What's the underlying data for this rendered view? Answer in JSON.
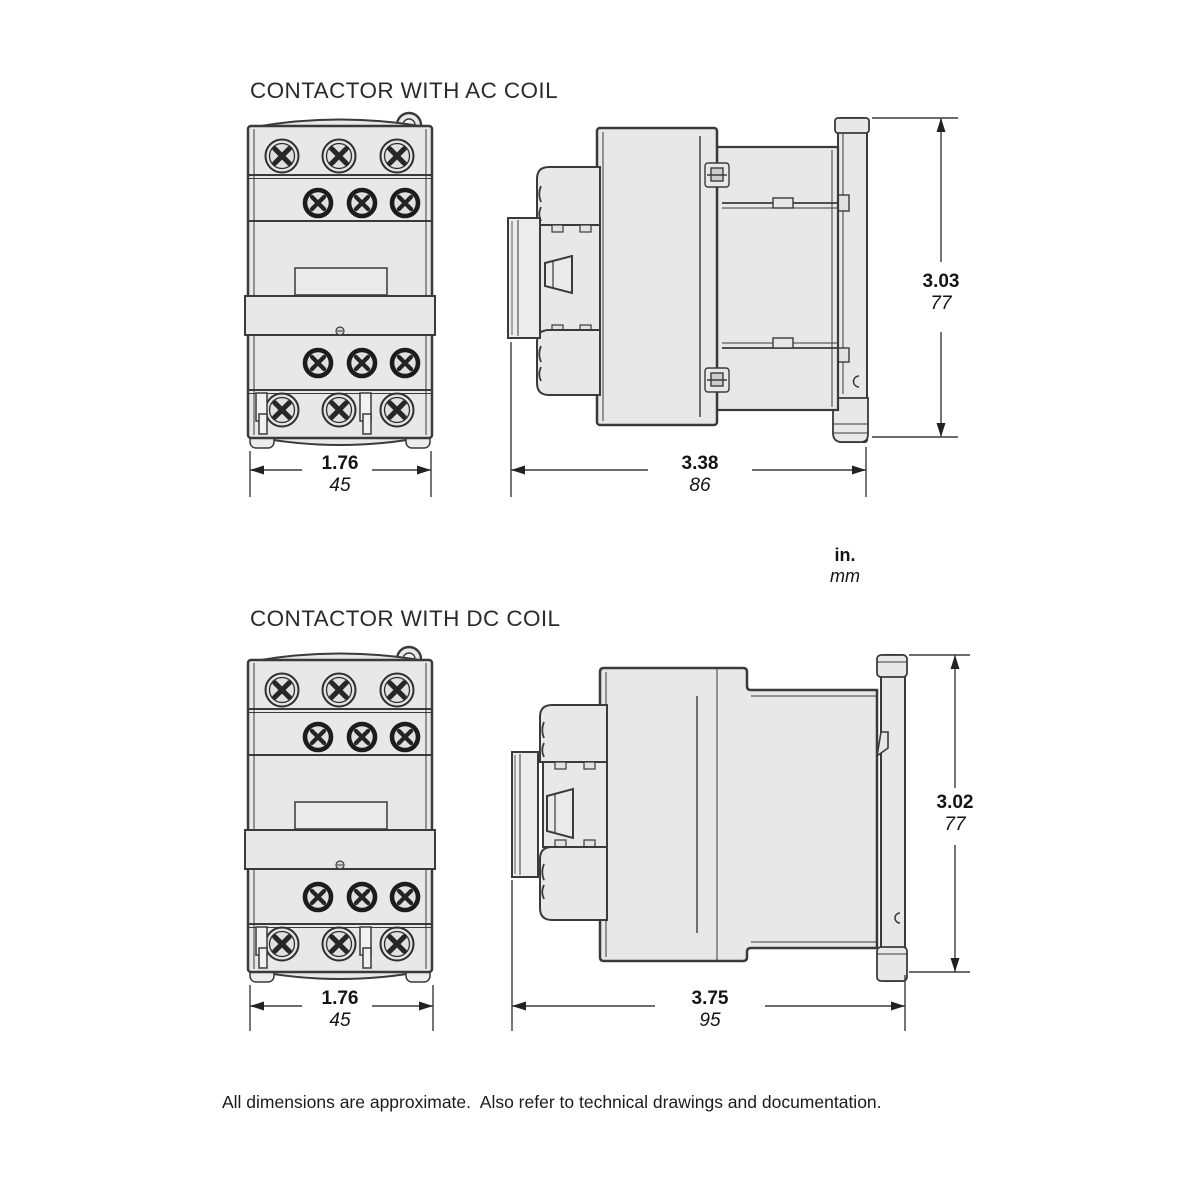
{
  "sections": {
    "ac": {
      "title": "CONTACTOR WITH AC COIL",
      "front_width": {
        "in": "1.76",
        "mm": "45"
      },
      "depth": {
        "in": "3.38",
        "mm": "86"
      },
      "height": {
        "in": "3.03",
        "mm": "77"
      }
    },
    "dc": {
      "title": "CONTACTOR WITH DC COIL",
      "front_width": {
        "in": "1.76",
        "mm": "45"
      },
      "depth": {
        "in": "3.75",
        "mm": "95"
      },
      "height": {
        "in": "3.02",
        "mm": "77"
      }
    }
  },
  "units": {
    "primary": "in.",
    "secondary": "mm"
  },
  "footer": {
    "note": "All dimensions are approximate.  Also refer to technical drawings and documentation."
  },
  "colors": {
    "line": "#3a3a3a",
    "fill": "#e8e8e8",
    "dim_line": "#3c3c3c",
    "text": "#141414"
  }
}
